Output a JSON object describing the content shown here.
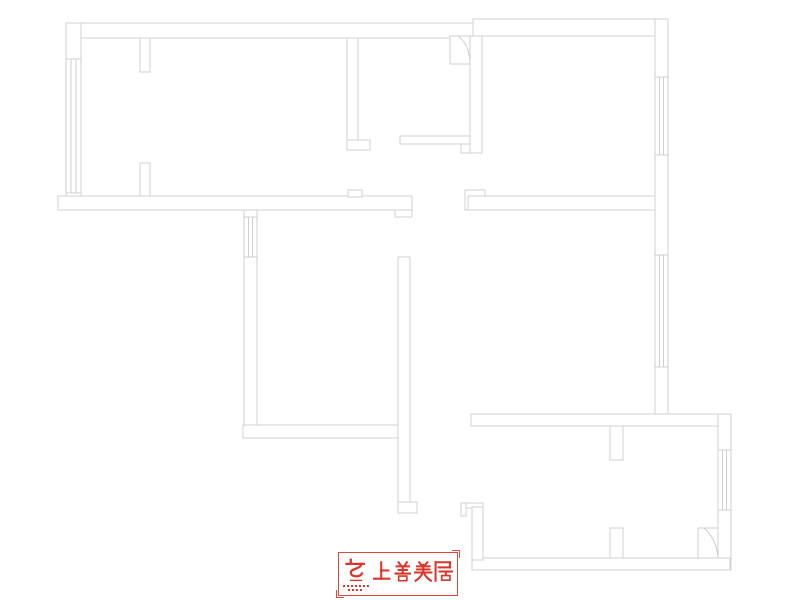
{
  "page": {
    "width": 800,
    "height": 600,
    "background": "#ffffff"
  },
  "floor_plan": {
    "stroke_color": "#d2d2d2",
    "walls": [
      {
        "name": "top-wall-left",
        "x": 66,
        "y": 23,
        "w": 407,
        "h": 15
      },
      {
        "name": "top-wall-right",
        "x": 473,
        "y": 19,
        "w": 195,
        "h": 17
      },
      {
        "name": "left-outer-wall",
        "x": 66,
        "y": 23,
        "w": 15,
        "h": 187
      },
      {
        "name": "hall-north-band",
        "x": 58,
        "y": 196,
        "w": 354,
        "h": 14
      },
      {
        "name": "hall-band-bump",
        "x": 348,
        "y": 190,
        "w": 14,
        "h": 7
      },
      {
        "name": "hall-band-end",
        "x": 395,
        "y": 210,
        "w": 17,
        "h": 7
      },
      {
        "name": "pier-top",
        "x": 140,
        "y": 38,
        "w": 10,
        "h": 34
      },
      {
        "name": "pier-bottom",
        "x": 140,
        "y": 163,
        "w": 10,
        "h": 33
      },
      {
        "name": "partition-top-middle",
        "x": 347,
        "y": 38,
        "w": 11,
        "h": 112
      },
      {
        "name": "partition-top-middle-foot",
        "x": 347,
        "y": 140,
        "w": 23,
        "h": 10
      },
      {
        "name": "corridor-band",
        "x": 400,
        "y": 136,
        "w": 70,
        "h": 8
      },
      {
        "name": "corridor-band-end",
        "x": 461,
        "y": 144,
        "w": 9,
        "h": 9
      },
      {
        "name": "topright-room-left-wall",
        "x": 470,
        "y": 36,
        "w": 12,
        "h": 117
      },
      {
        "name": "right-outer-wall-upper",
        "x": 655,
        "y": 19,
        "w": 13,
        "h": 396
      },
      {
        "name": "band-b-endcap",
        "x": 465,
        "y": 190,
        "w": 20,
        "h": 20
      },
      {
        "name": "band-b",
        "x": 468,
        "y": 196,
        "w": 187,
        "h": 14
      },
      {
        "name": "band-c",
        "x": 471,
        "y": 414,
        "w": 259,
        "h": 12
      },
      {
        "name": "pillar-upper",
        "x": 610,
        "y": 426,
        "w": 13,
        "h": 34
      },
      {
        "name": "right-outer-wall-lower",
        "x": 718,
        "y": 414,
        "w": 13,
        "h": 156
      },
      {
        "name": "bottom-band",
        "x": 472,
        "y": 558,
        "w": 258,
        "h": 12
      },
      {
        "name": "pillar-lower",
        "x": 610,
        "y": 528,
        "w": 13,
        "h": 30
      },
      {
        "name": "step-top-bar",
        "x": 461,
        "y": 503,
        "w": 22,
        "h": 5
      },
      {
        "name": "step-left-bit",
        "x": 461,
        "y": 503,
        "w": 5,
        "h": 13
      },
      {
        "name": "bottomroom-left-wall",
        "x": 472,
        "y": 507,
        "w": 11,
        "h": 53
      },
      {
        "name": "centralroom-left-wall",
        "x": 244,
        "y": 210,
        "w": 13,
        "h": 228
      },
      {
        "name": "centralroom-bottom-band",
        "x": 243,
        "y": 425,
        "w": 155,
        "h": 13
      },
      {
        "name": "central-wall",
        "x": 398,
        "y": 257,
        "w": 12,
        "h": 256
      },
      {
        "name": "central-wall-foot",
        "x": 398,
        "y": 502,
        "w": 19,
        "h": 11
      }
    ],
    "windows": [
      {
        "name": "window-left-balcony",
        "x": 66,
        "y": 59,
        "w": 15,
        "h": 134,
        "o": "v"
      },
      {
        "name": "window-topright-room",
        "x": 655,
        "y": 77,
        "w": 13,
        "h": 78,
        "o": "v"
      },
      {
        "name": "window-middle-right",
        "x": 655,
        "y": 255,
        "w": 13,
        "h": 112,
        "o": "v"
      },
      {
        "name": "window-bottomright-room",
        "x": 718,
        "y": 450,
        "w": 13,
        "h": 60,
        "o": "v"
      },
      {
        "name": "window-central-room",
        "x": 244,
        "y": 217,
        "w": 13,
        "h": 40,
        "o": "v"
      }
    ],
    "doors": [
      {
        "name": "door-entry-top",
        "frame": {
          "x": 450,
          "y": 36,
          "w": 20,
          "h": 28
        },
        "arc": "M458,36 Q469,44 470,62"
      },
      {
        "name": "door-bottomright",
        "lines": [
          "M698,528 L718,528",
          "M698,528 L698,559"
        ],
        "arc": "M704,528 Q717,540 718,558"
      }
    ]
  },
  "logo": {
    "text": "上善美居",
    "color": "#d9352b",
    "border_color": "#e0463a"
  }
}
